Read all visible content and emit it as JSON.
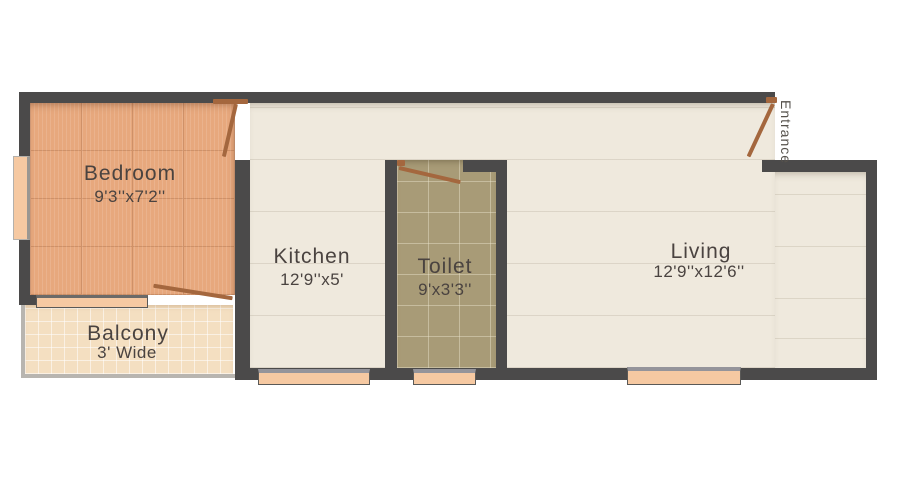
{
  "plan_title": "Apartment floor plan",
  "rooms": {
    "bedroom": {
      "name": "Bedroom",
      "dims": "9'3''x7'2''"
    },
    "balcony": {
      "name": "Balcony",
      "dims": "3' Wide"
    },
    "kitchen": {
      "name": "Kitchen",
      "dims": "12'9''x5'"
    },
    "toilet": {
      "name": "Toilet",
      "dims": "9'x3'3''"
    },
    "living": {
      "name": "Living",
      "dims": "12'9''x12'6''"
    },
    "entrance": {
      "name": "Entrance"
    }
  },
  "colors": {
    "wall": "#4b4a4a",
    "bedroom_floor": "#e7a87d",
    "balcony_floor": "#f4dfc1",
    "kitchen_living_floor": "#efe9dd",
    "toilet_floor": "#a89b77",
    "window_sill": "#f6c9a2",
    "door": "#a4673e",
    "label_text": "#4a4340",
    "background": "#ffffff"
  }
}
